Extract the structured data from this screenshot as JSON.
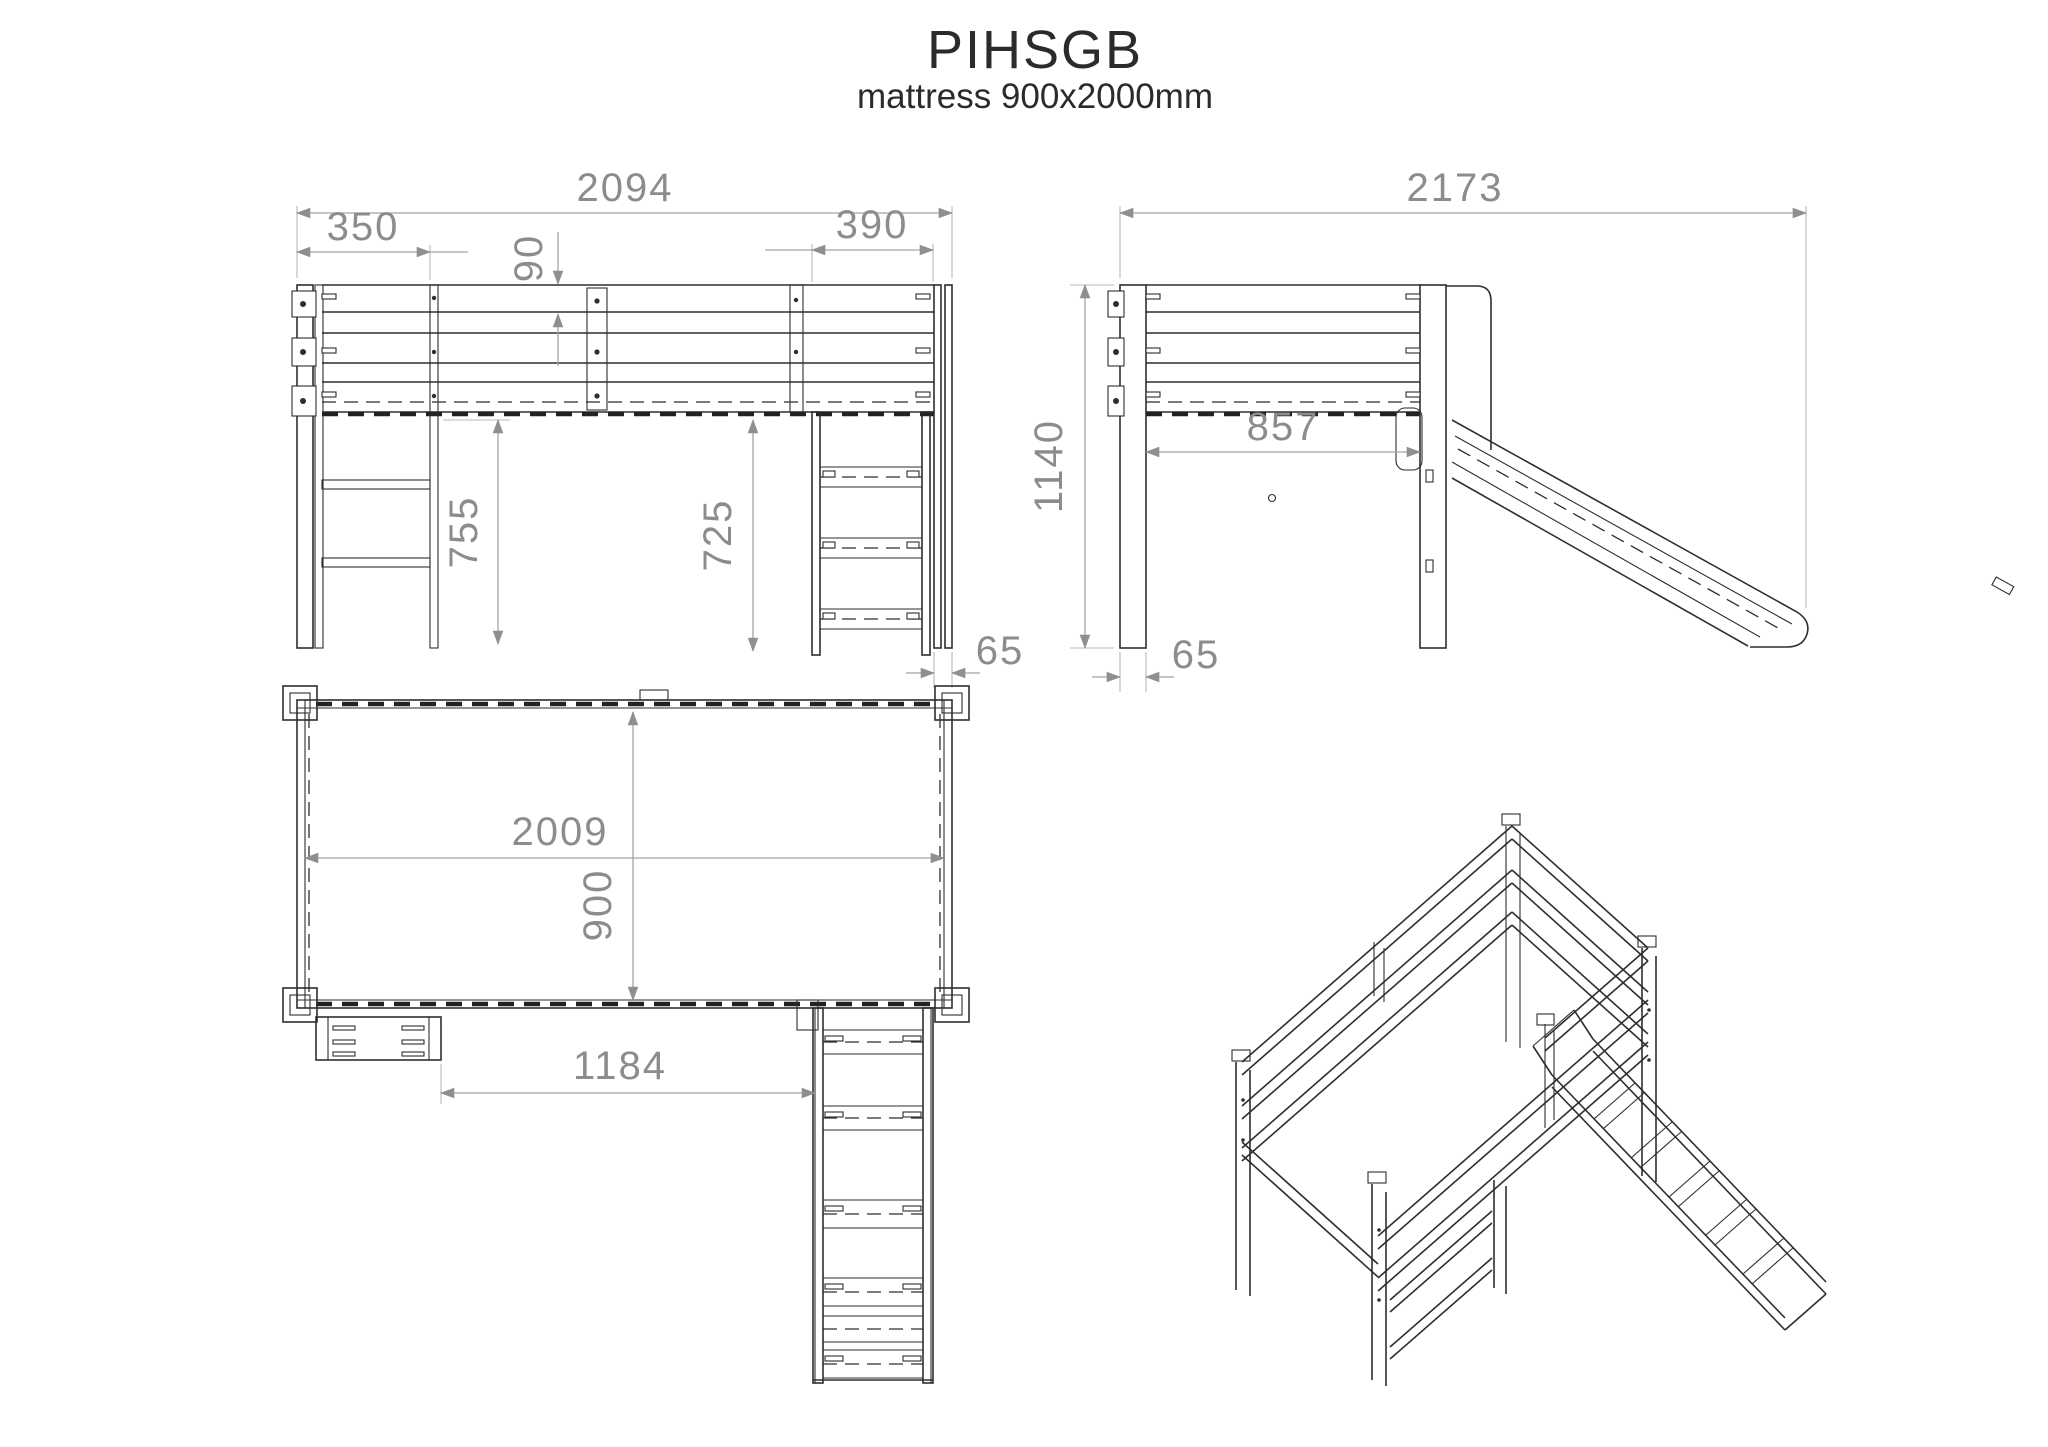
{
  "title": "PIHSGB",
  "subtitle": "mattress 900x2000mm",
  "colors": {
    "geometry_line": "#2e2e2e",
    "dimension_line": "#a3a3a3",
    "dimension_text": "#8c8c8c",
    "background": "#ffffff"
  },
  "views": {
    "front": {
      "dims": {
        "overall_width": "2094",
        "left_bay": "350",
        "guard_rail": "90",
        "ladder_bay": "390",
        "height_under_left": "755",
        "height_under_ladder": "725",
        "post_width": "65"
      }
    },
    "side": {
      "dims": {
        "overall_depth": "2173",
        "overall_height": "1140",
        "inner_depth": "857",
        "post_width": "65"
      }
    },
    "plan": {
      "dims": {
        "inner_length": "2009",
        "inner_width": "900",
        "shelf_to_ladder": "1184"
      }
    }
  }
}
